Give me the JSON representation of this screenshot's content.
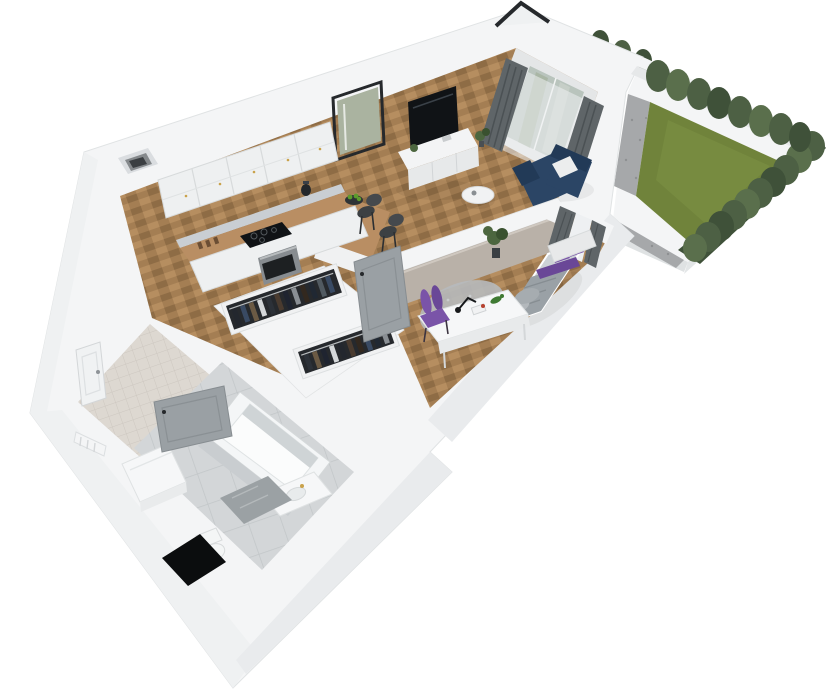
{
  "scene": {
    "description": "3D cutaway floor-plan render of a small apartment with a fenced garden",
    "view": "isometric cutaway",
    "background": "#ffffff"
  },
  "palette": {
    "wall_top": "#f4f5f6",
    "wall_face": "#e9ebed",
    "wall_face_light": "#eff1f2",
    "wall_face_dark": "#dadde0",
    "interior_wall_face": "#b9b1a8",
    "floor_oak": "#a47e53",
    "floor_oak_light": "#b68e60",
    "floor_oak_dark": "#8e6c45",
    "tile_floor": "#d3d6d8",
    "tile_grout": "#c2c6c8",
    "entry_tile": "#ddd8d1",
    "entry_tile_line": "#cdc7c0",
    "grass": "#70833b",
    "grass_light": "#7e9245",
    "hedge": "#4d6044",
    "hedge_dark": "#3f5139",
    "hedge_light": "#5a6f4c",
    "gravel": "#a6a8aa",
    "counter_wood": "#b98e63",
    "marble": "#c9ced3",
    "cabinet_white": "#eef0f1",
    "steel": "#878c90",
    "tv_black": "#101316",
    "sofa_navy": "#2b4565",
    "sofa_navy_dark": "#223a57",
    "cushion_white": "#eceded",
    "curtain_gray": "#5f6568",
    "sheer": "#eef0f2",
    "glass": "#b9c4bd",
    "purple": "#7a54a8",
    "purple_dark": "#6a4797",
    "blanket_gray": "#9aa1a6",
    "sheet_light": "#cdd2d6",
    "pillow_gray": "#b3b8bc",
    "rug_gray": "#b7babc",
    "door_gray": "#9aa0a4",
    "plant_green": "#4c663f",
    "plant_dark": "#39512f",
    "tub_white": "#f4f6f7",
    "shaft_black": "#0b0d0e",
    "gold": "#c9a24b",
    "mat_stone": "#9ba1a4",
    "apple_green": "#5d9b2d",
    "frame_dark": "#26292c",
    "rack_dark": "#26292d"
  },
  "clothes": [
    "#23272e",
    "#394a63",
    "#6b5a44",
    "#d5d8da",
    "#2c3138",
    "#4a3b2f",
    "#1f2430",
    "#8a8f94",
    "#32281f",
    "#202833",
    "#515a61"
  ],
  "rooms": [
    {
      "id": "kitchen",
      "items": [
        "upper cabinets",
        "marble backsplash",
        "wood countertop",
        "induction cooktop",
        "built-in oven",
        "kettle",
        "fruit bowl",
        "peninsula",
        "bar stools"
      ]
    },
    {
      "id": "living-room",
      "items": [
        "wall TV",
        "media sideboard",
        "leaning mirror",
        "glass patio door",
        "sheer curtain",
        "gray curtains",
        "navy corner sofa",
        "white cushion",
        "round coffee table",
        "potted plant"
      ]
    },
    {
      "id": "bedroom",
      "items": [
        "double bed",
        "white headboard",
        "gray blanket",
        "purple pillows",
        "purple throw",
        "window curtains",
        "corner plant",
        "round rug",
        "white desk",
        "purple chair",
        "desk lamp",
        "books",
        "toy dinosaur"
      ]
    },
    {
      "id": "wardrobe-hall",
      "items": [
        "open wardrobe rack",
        "hanging clothes",
        "open interior door"
      ]
    },
    {
      "id": "entry-hall",
      "items": [
        "entrance door",
        "radiator",
        "washing machine"
      ]
    },
    {
      "id": "bathroom",
      "items": [
        "bathtub",
        "toilet",
        "vanity sink",
        "gold faucet",
        "stone mat",
        "installation shaft",
        "open bathroom door",
        "tile floor"
      ]
    },
    {
      "id": "garden",
      "items": [
        "lawn",
        "trimmed bush row",
        "dense hedge",
        "gravel strip"
      ]
    }
  ],
  "garden": {
    "bush_row_count": 8,
    "hedge_side": "right",
    "lawn_shape": "trapezoid"
  }
}
